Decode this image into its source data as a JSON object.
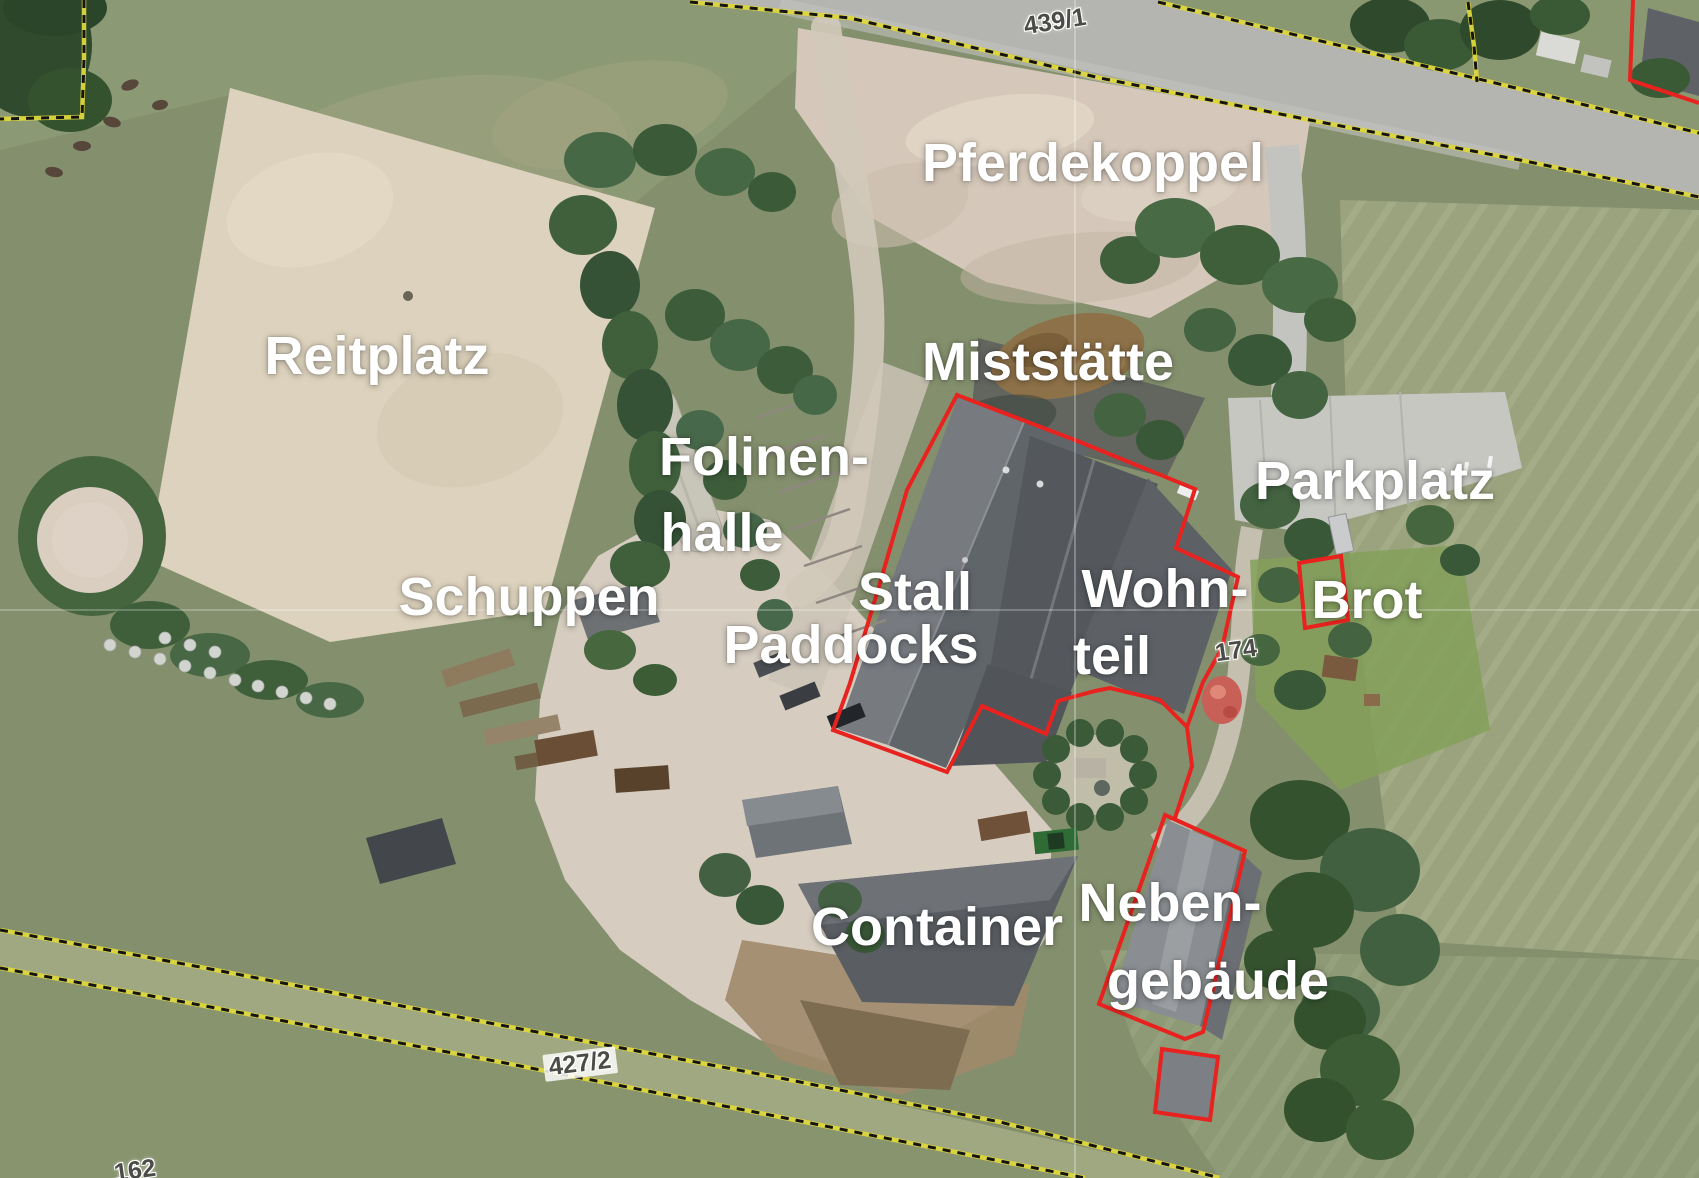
{
  "area_labels": {
    "pferdekoppel": "Pferdekoppel",
    "reitplatz": "Reitplatz",
    "miststaette": "Miststätte",
    "folinenhalle_line1": "Folinen-",
    "folinenhalle_line2": "halle",
    "schuppen": "Schuppen",
    "stall": "Stall",
    "paddocks": "Paddocks",
    "wohnteil_line1": "Wohn-",
    "wohnteil_line2": "teil",
    "parkplatz": "Parkplatz",
    "brot": "Brot",
    "container": "Container",
    "nebengebaeude_line1": "Neben-",
    "nebengebaeude_line2": "gebäude"
  },
  "parcel_numbers": {
    "p439": "439/1",
    "p427": "427/2",
    "p162": "162",
    "p174": "174"
  },
  "colors": {
    "building_outline_red": "#e8221f",
    "parcel_boundary_yellow": "#ded73c",
    "parcel_boundary_black": "#141414",
    "area_label_text": "#ffffff",
    "parcel_number_text": "#4b4b47"
  }
}
